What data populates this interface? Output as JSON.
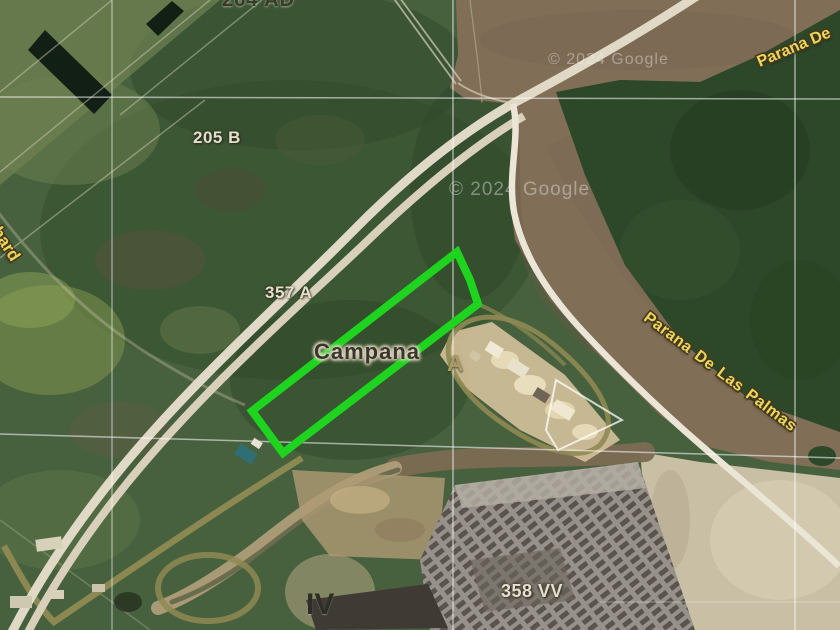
{
  "labels": {
    "parcel_264": "264 AD",
    "parcel_205": "205 B",
    "parcel_357": "357 A",
    "parcel_fragment_a": "A",
    "zone_iv": "IV",
    "parcel_358": "358 VV",
    "city": "Campana",
    "road_fragment": "chard",
    "river_top_right": "Parana De",
    "river_main": "Parana De Las Palmas"
  },
  "watermark": {
    "center": "© 2024 Google",
    "top_right": "© 2024 Google"
  },
  "colors": {
    "highlight_green": "#1ed41e",
    "water_brown": "#806e57",
    "vegetation_green": "#47613e",
    "island_green": "#2d4829",
    "sand_tan": "#c9bfa4",
    "label_yellow": "#ecd65a"
  }
}
